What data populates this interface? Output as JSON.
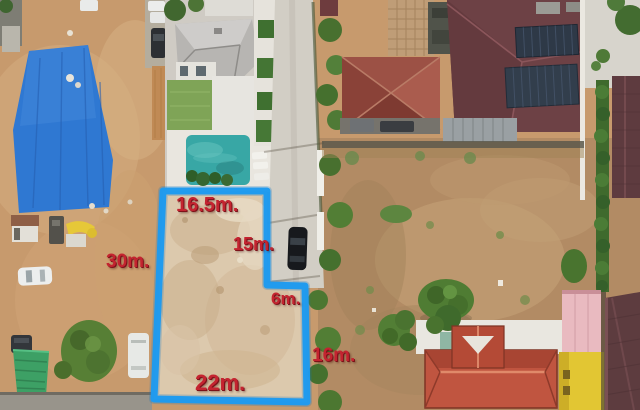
{
  "scene": {
    "type": "aerial-drone-photograph",
    "subject": "Vacant land plot marked with a blue boundary outline and red dimension labels, surrounded by houses, a pool villa, a road and dirt fields"
  },
  "annotations": {
    "top_edge": {
      "label": "16.5m."
    },
    "right_upper_edge": {
      "label": "15m."
    },
    "notch_edge": {
      "label": "6m."
    },
    "left_edge": {
      "label": "30m."
    },
    "right_lower_edge": {
      "label": "16m."
    },
    "bottom_edge": {
      "label": "22m."
    }
  },
  "colors": {
    "annotation_red": "#c42430",
    "plot_outline_blue": "#1d9af0",
    "plot_dirt": "#dcc9ad",
    "left_yard_dirt": "#c79a6d",
    "field_dirt": "#b28b64",
    "road_gray": "#d2cec5",
    "pool_teal": "#38a7a5",
    "blue_roof": "#2f78d2",
    "gray_roof": "#b7b5b2",
    "maroon_roof": "#6d4145",
    "terracotta_roof": "#9c5145",
    "bright_red_roof": "#c05540",
    "pink_building": "#e9bac0",
    "yellow_building": "#e2c633",
    "dark_maroon_roof": "#5d3c3f",
    "tree_green": "#4f7c33",
    "lawn_green": "#7fa457"
  }
}
